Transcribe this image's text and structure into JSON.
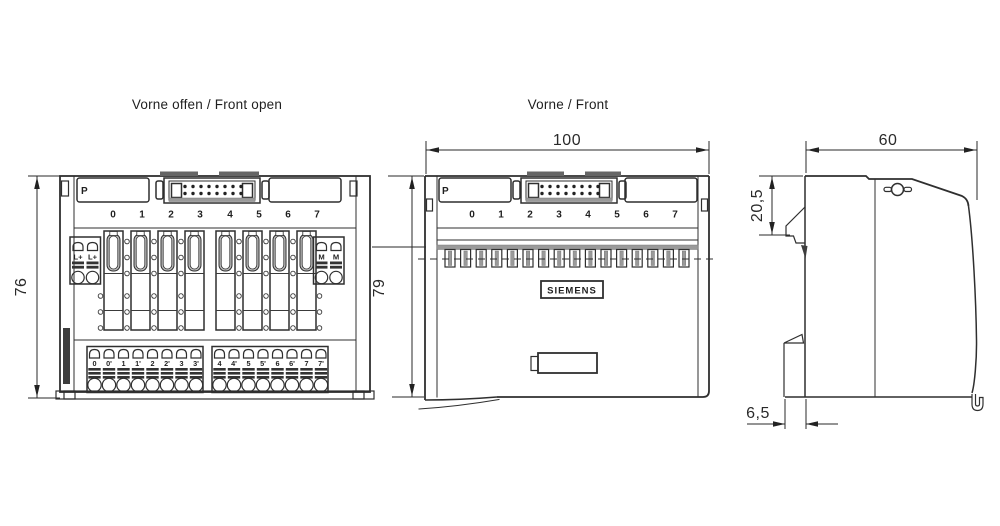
{
  "titles": {
    "front_open": "Vorne offen / Front open",
    "front": "Vorne / Front"
  },
  "dimensions": {
    "front_open_height": "76",
    "front_width": "100",
    "front_height": "79",
    "side_width": "60",
    "side_latch_offset": "20,5",
    "side_rail_depth": "6,5"
  },
  "labels": {
    "bus_label": "P",
    "brand": "SIEMENS",
    "channels": [
      "0",
      "1",
      "2",
      "3",
      "4",
      "5",
      "6",
      "7"
    ],
    "power_left": [
      "L+",
      "L+"
    ],
    "power_right": [
      "M",
      "M"
    ],
    "terminals": [
      "0",
      "0'",
      "1",
      "1'",
      "2",
      "2'",
      "3",
      "3'",
      "4",
      "4'",
      "5",
      "5'",
      "6",
      "6'",
      "7",
      "7'"
    ]
  },
  "colors": {
    "line": "#2f2f2f",
    "shade": "#9a9a9a",
    "slot_shade": "#b9b9b9",
    "background": "#ffffff"
  }
}
